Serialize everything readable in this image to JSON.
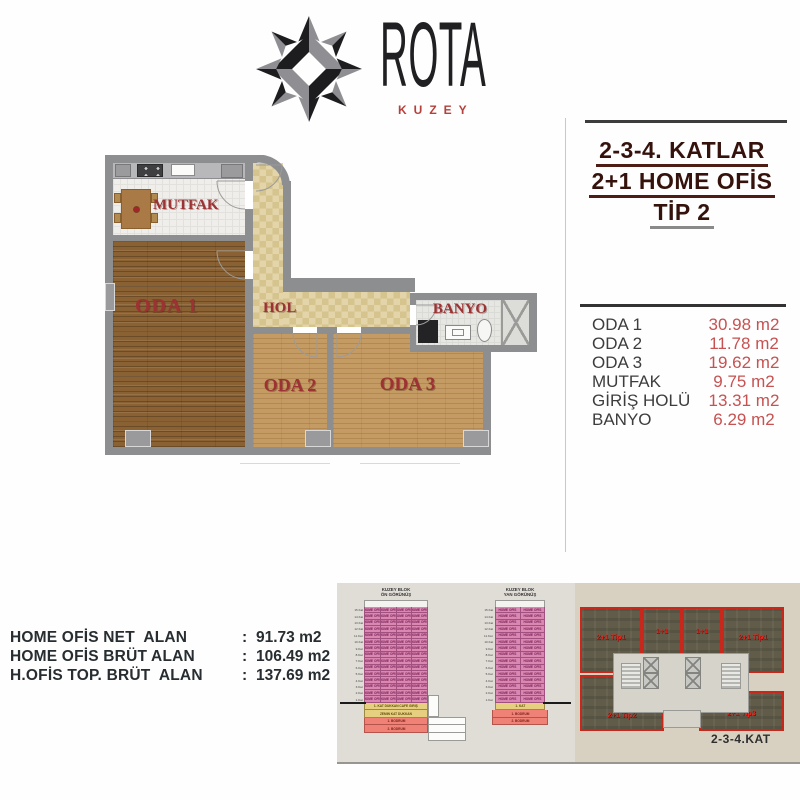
{
  "brand": {
    "name": "ROTA",
    "subtitle": "KUZEY"
  },
  "title_block": {
    "lines": [
      "2-3-4. KATLAR",
      "2+1 HOME OFİS",
      "TİP 2"
    ]
  },
  "area_table": {
    "rows": [
      {
        "label": "ODA 1",
        "value": "30.98 m2"
      },
      {
        "label": "ODA 2",
        "value": "11.78 m2"
      },
      {
        "label": "ODA 3",
        "value": "19.62 m2"
      },
      {
        "label": "MUTFAK",
        "value": "9.75 m2"
      },
      {
        "label": "GİRİŞ HOLÜ",
        "value": "13.31 m2"
      },
      {
        "label": "BANYO",
        "value": "6.29 m2"
      }
    ]
  },
  "floor_plan": {
    "rooms": {
      "mutfak": "MUTFAK",
      "oda1": "ODA 1",
      "hol": "HOL",
      "banyo": "BANYO",
      "oda2": "ODA 2",
      "oda3": "ODA 3"
    }
  },
  "summary": {
    "rows": [
      {
        "label": "HOME OFİS NET  ALAN",
        "sep": ":",
        "value": "91.73 m2"
      },
      {
        "label": "HOME OFİS BRÜT ALAN",
        "sep": ":",
        "value": "106.49 m2"
      },
      {
        "label": "H.OFİS TOP. BRÜT  ALAN",
        "sep": ":",
        "value": "137.69 m2"
      }
    ]
  },
  "elevations": {
    "front": {
      "title_line1": "KUZEY BLOK",
      "title_line2": "ÖN GÖRÜNÜŞ",
      "cells_per_floor": 4
    },
    "side": {
      "title_line1": "KUZEY BLOK",
      "title_line2": "YAN GÖRÜNÜŞ",
      "cells_per_floor": 2
    },
    "floors": 15,
    "cell_label": "HOME OFİS",
    "floor_labels": [
      "15.Kat",
      "14.Kat",
      "13.Kat",
      "12.Kat",
      "11.Kat",
      "10.Kat",
      "9.Kat",
      "8.Kat",
      "7.Kat",
      "6.Kat",
      "5.Kat",
      "4.Kat",
      "3.Kat",
      "2.Kat",
      "1.Kat"
    ],
    "front_base": [
      {
        "color": "yellow",
        "label": "1. KAT DÜKKAN CAFE GİRİŞ"
      },
      {
        "color": "yellow",
        "label": "ZEMİN KAT DÜKKAN"
      },
      {
        "color": "red",
        "label": "1. BODRUM"
      },
      {
        "color": "red",
        "label": "2. BODRUM"
      }
    ],
    "side_base": [
      {
        "color": "yellow",
        "label": "1. KAT"
      },
      {
        "color": "red",
        "label": "1. BODRUM"
      },
      {
        "color": "red",
        "label": "2. BODRUM"
      }
    ]
  },
  "key_plan": {
    "caption": "2-3-4.KAT",
    "units": [
      {
        "label": "2+1 Tip1"
      },
      {
        "label": "1+1"
      },
      {
        "label": "1+1"
      },
      {
        "label": "2+1 Tip1"
      },
      {
        "label": "2+1 Tip2"
      },
      {
        "label": "2+1 Tip3"
      }
    ]
  },
  "colors": {
    "accent_value_red": "#c65251",
    "room_label_red": "#9d3133",
    "title_maroon": "#35120c",
    "brand_red": "#b5403c",
    "elev_pink": "#da87b2",
    "elev_yellow": "#e6cf7e",
    "elev_salmon": "#ef8176",
    "unit_olive": "#615c49",
    "unit_outline_red": "#c8281c"
  }
}
